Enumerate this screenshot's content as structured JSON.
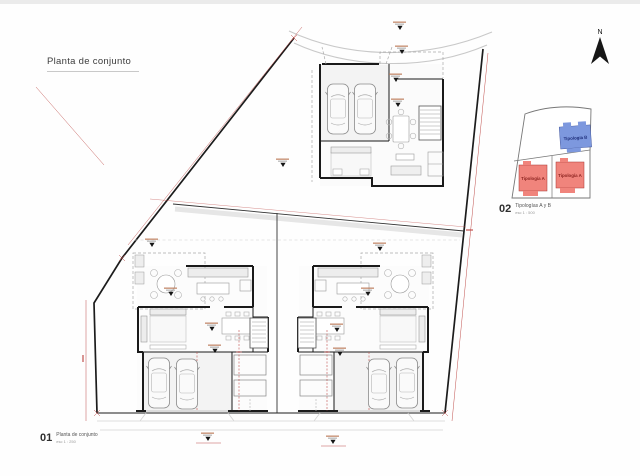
{
  "document": {
    "title": "Planta de conjunto"
  },
  "north_arrow": {
    "label": "N"
  },
  "key_plan": {
    "unit_b_label": "Tipología B",
    "unit_a_left_label": "Tipología A",
    "unit_a_right_label": "Tipología A"
  },
  "sheet_labels": {
    "main": {
      "number": "01",
      "title": "Planta de conjunto",
      "scale": "esc 1 : 250"
    },
    "key": {
      "number": "02",
      "title": "Tipologías A y B",
      "scale": "esc 1 : 500"
    }
  },
  "colors": {
    "tipologia_a_fill": "#f0847c",
    "tipologia_a_text": "#8c2420",
    "tipologia_b_fill": "#7d98de",
    "tipologia_b_text": "#20307c",
    "dimension_red": "#c0504d",
    "wall": "#1a1a1a"
  }
}
